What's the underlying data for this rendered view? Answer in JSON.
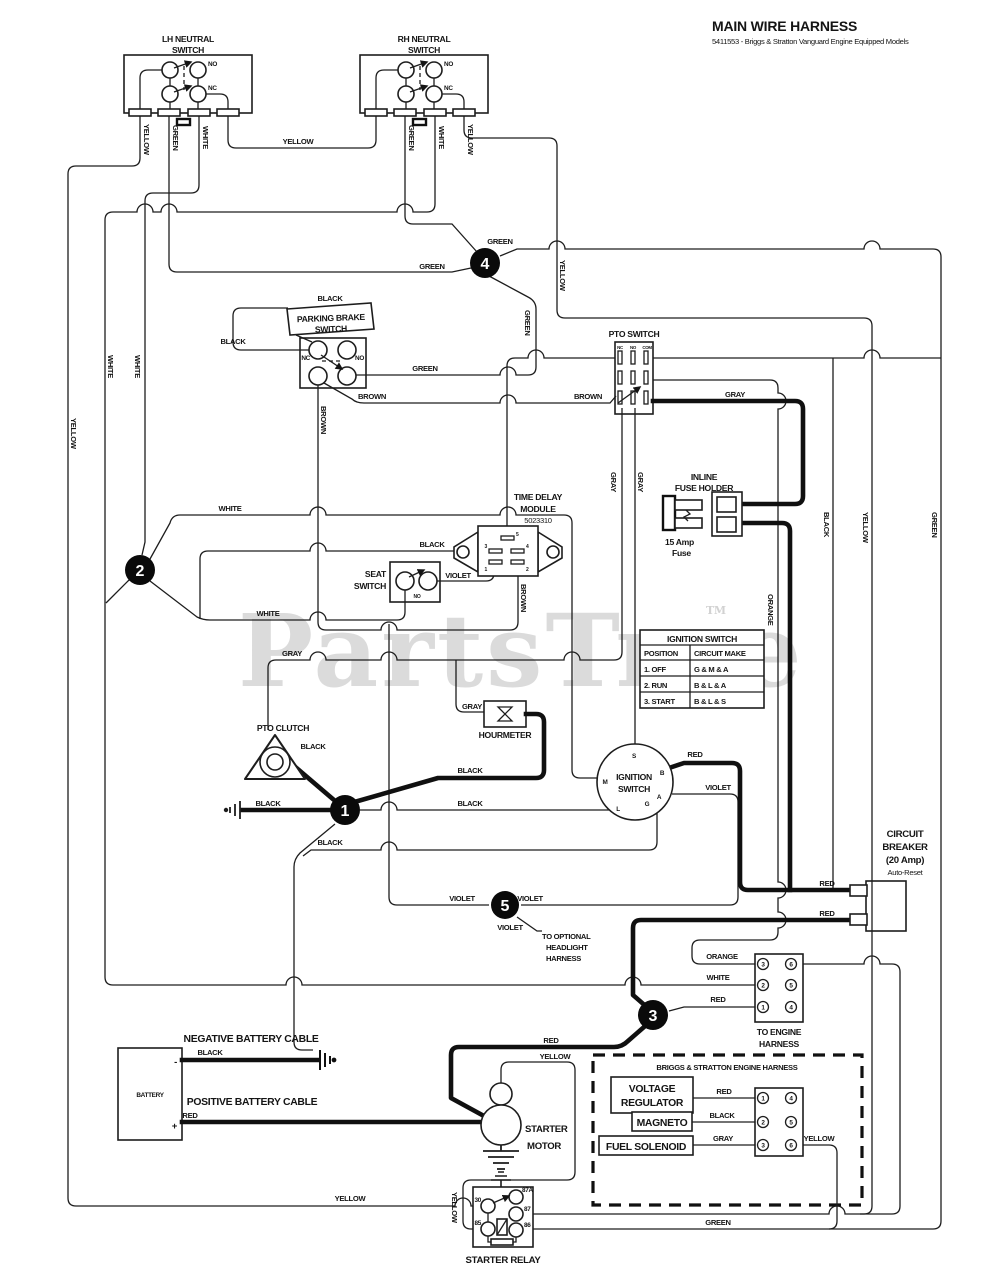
{
  "title": {
    "main": "MAIN WIRE HARNESS",
    "subtitle": "5411553 - Briggs & Stratton Vanguard Engine Equipped Models"
  },
  "watermark": {
    "text": "PartsTree",
    "tm": "TM"
  },
  "wire_colors": {
    "yellow": "YELLOW",
    "green": "GREEN",
    "white": "WHITE",
    "black": "BLACK",
    "brown": "BROWN",
    "gray": "GRAY",
    "violet": "VIOLET",
    "red": "RED",
    "orange": "ORANGE"
  },
  "contacts": {
    "no": "NO",
    "nc": "NC",
    "com": "COM"
  },
  "markers": {
    "m1": "1",
    "m2": "2",
    "m3": "3",
    "m4": "4",
    "m5": "5"
  },
  "lh_neutral_switch": {
    "line1": "LH NEUTRAL",
    "line2": "SWITCH"
  },
  "rh_neutral_switch": {
    "line1": "RH NEUTRAL",
    "line2": "SWITCH"
  },
  "parking_brake_switch": {
    "line1": "PARKING BRAKE",
    "line2": "SWITCH"
  },
  "pto_switch": {
    "label": "PTO SWITCH"
  },
  "time_delay_module": {
    "line1": "TIME DELAY",
    "line2": "MODULE",
    "part": "5023310",
    "pins": {
      "p1": "1",
      "p2": "2",
      "p3": "3",
      "p4": "4",
      "p5": "5"
    }
  },
  "seat_switch": {
    "line1": "SEAT",
    "line2": "SWITCH"
  },
  "inline_fuse_holder": {
    "line1": "INLINE",
    "line2": "FUSE HOLDER",
    "fuse1": "15 Amp",
    "fuse2": "Fuse"
  },
  "ignition_table": {
    "header": "IGNITION SWITCH",
    "col1": "POSITION",
    "col2": "CIRCUIT MAKE",
    "rows": [
      {
        "position": "1. OFF",
        "make": "G & M & A"
      },
      {
        "position": "2. RUN",
        "make": "B & L & A"
      },
      {
        "position": "3. START",
        "make": "B & L & S"
      }
    ]
  },
  "pto_clutch": {
    "label": "PTO CLUTCH"
  },
  "hourmeter": {
    "label": "HOURMETER"
  },
  "ignition_switch": {
    "line1": "IGNITION",
    "line2": "SWITCH",
    "terminals": {
      "s": "S",
      "m": "M",
      "b": "B",
      "a": "A",
      "l": "L",
      "g": "G"
    }
  },
  "circuit_breaker": {
    "line1": "CIRCUIT",
    "line2": "BREAKER",
    "line3": "(20 Amp)",
    "line4": "Auto-Reset"
  },
  "headlight": {
    "line1": "TO OPTIONAL",
    "line2": "HEADLIGHT",
    "line3": "HARNESS"
  },
  "engine_connector": {
    "line1": "TO ENGINE",
    "line2": "HARNESS",
    "left_pins": [
      "3",
      "2",
      "1"
    ],
    "right_pins": [
      "6",
      "5",
      "4"
    ]
  },
  "battery": {
    "label": "BATTERY",
    "neg": "-",
    "pos": "+",
    "neg_cable": "NEGATIVE BATTERY CABLE",
    "pos_cable": "POSITIVE BATTERY CABLE"
  },
  "starter_motor": {
    "line1": "STARTER",
    "line2": "MOTOR"
  },
  "bs_harness": {
    "title": "BRIGGS & STRATTON ENGINE HARNESS",
    "vr1": "VOLTAGE",
    "vr2": "REGULATOR",
    "magneto": "MAGNETO",
    "fuel_solenoid": "FUEL SOLENOID",
    "left_pins": [
      "1",
      "2",
      "3"
    ],
    "right_pins": [
      "4",
      "5",
      "6"
    ]
  },
  "starter_relay": {
    "label": "STARTER RELAY",
    "t30": "30",
    "t87a": "87A",
    "t87": "87",
    "t85": "85",
    "t86": "86"
  }
}
